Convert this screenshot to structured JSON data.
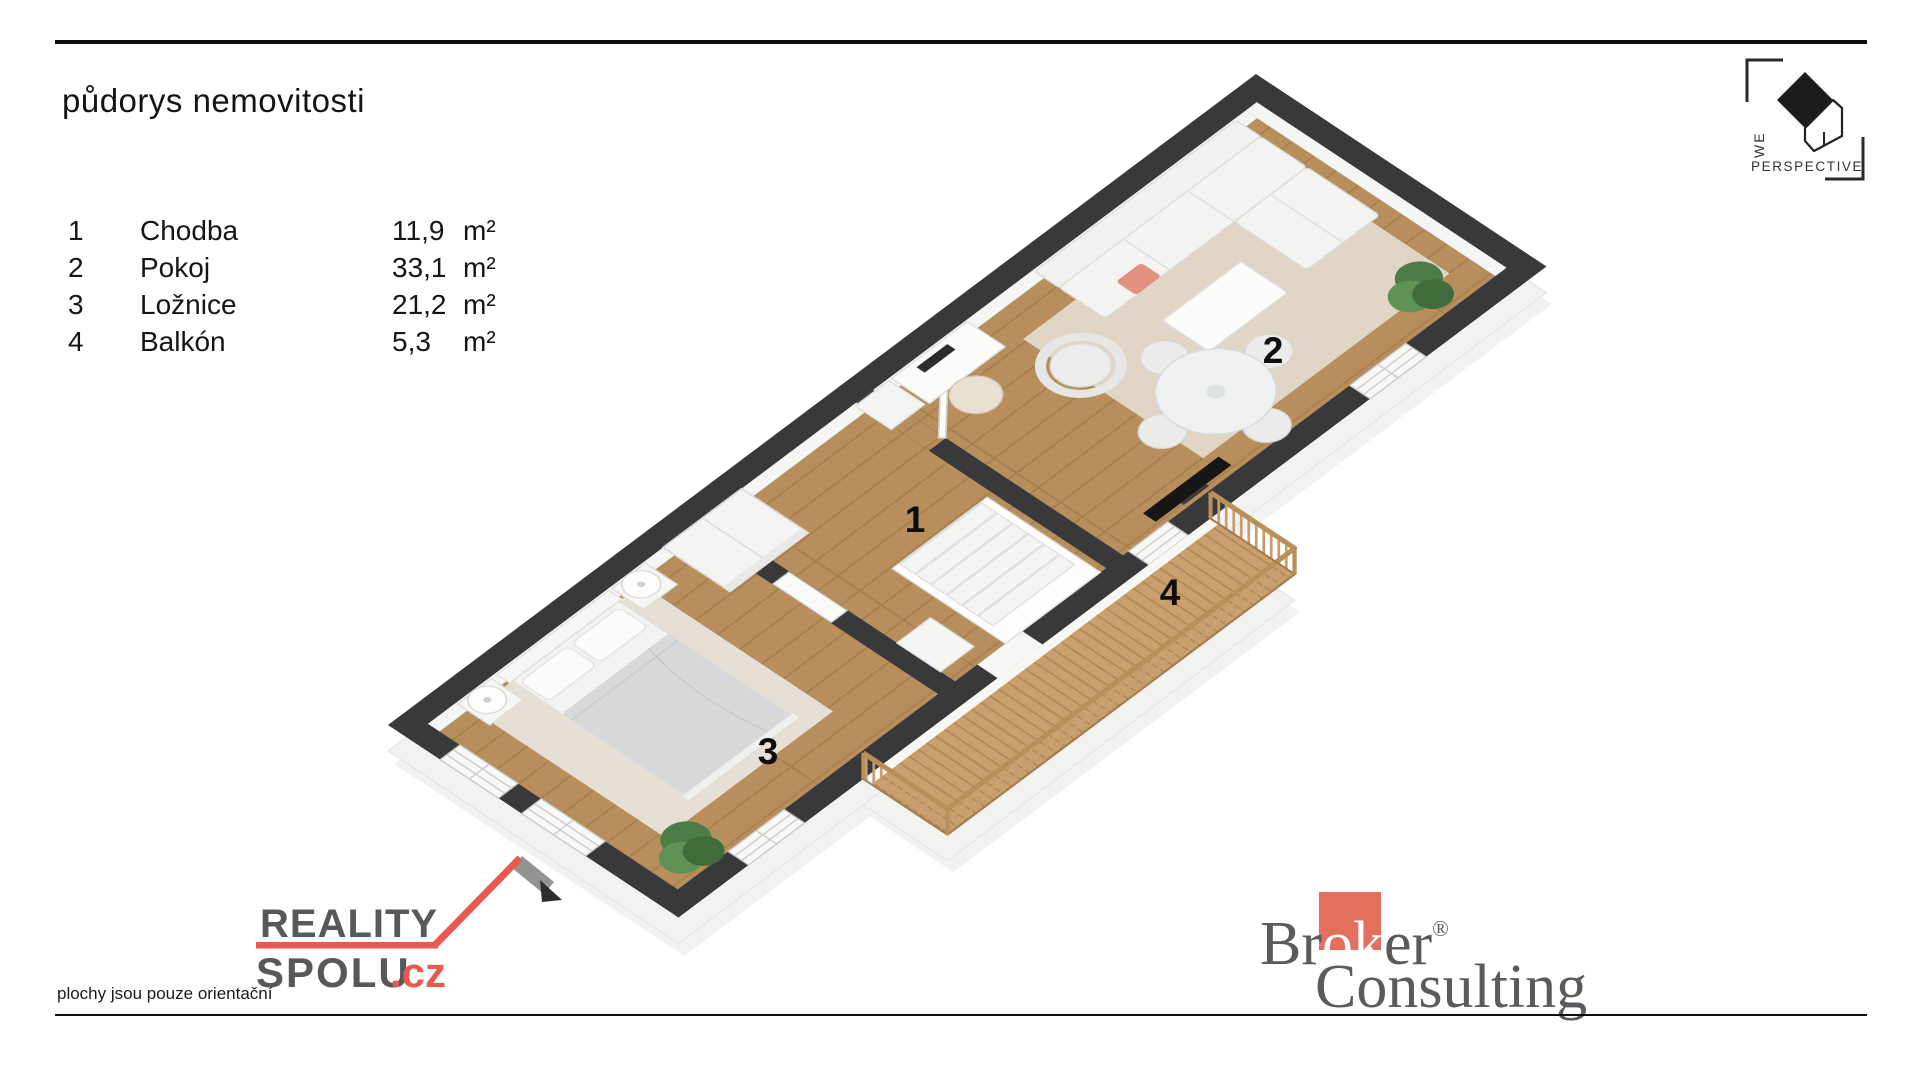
{
  "header": {
    "title": "půdorys nemovitosti"
  },
  "legend": {
    "rooms": [
      {
        "number": "1",
        "name": "Chodba",
        "area": "11,9",
        "unit": "m²"
      },
      {
        "number": "2",
        "name": "Pokoj",
        "area": "33,1",
        "unit": "m²"
      },
      {
        "number": "3",
        "name": "Ložnice",
        "area": "21,2",
        "unit": "m²"
      },
      {
        "number": "4",
        "name": "Balkón",
        "area": "5,3",
        "unit": "m²"
      }
    ]
  },
  "footer": {
    "disclaimer": "plochy jsou pouze orientační"
  },
  "logos": {
    "weperspective": {
      "we": "WE",
      "perspective": "PERSPECTIVE"
    },
    "realityspolu": {
      "line1": "REALITY",
      "line2": "SPOLU",
      "tld": ".cz"
    },
    "broker": {
      "br": "Br",
      "ok": "ok",
      "er": "er",
      "reg": "®",
      "line2": "Consulting"
    }
  },
  "colors": {
    "accent_red": "#e85a50",
    "broker_square": "#e2705c",
    "wall_dark": "#38393b",
    "floor_wood": "#b78e5c",
    "deck_wood": "#c9a06d",
    "logo_gray": "#57585a"
  }
}
